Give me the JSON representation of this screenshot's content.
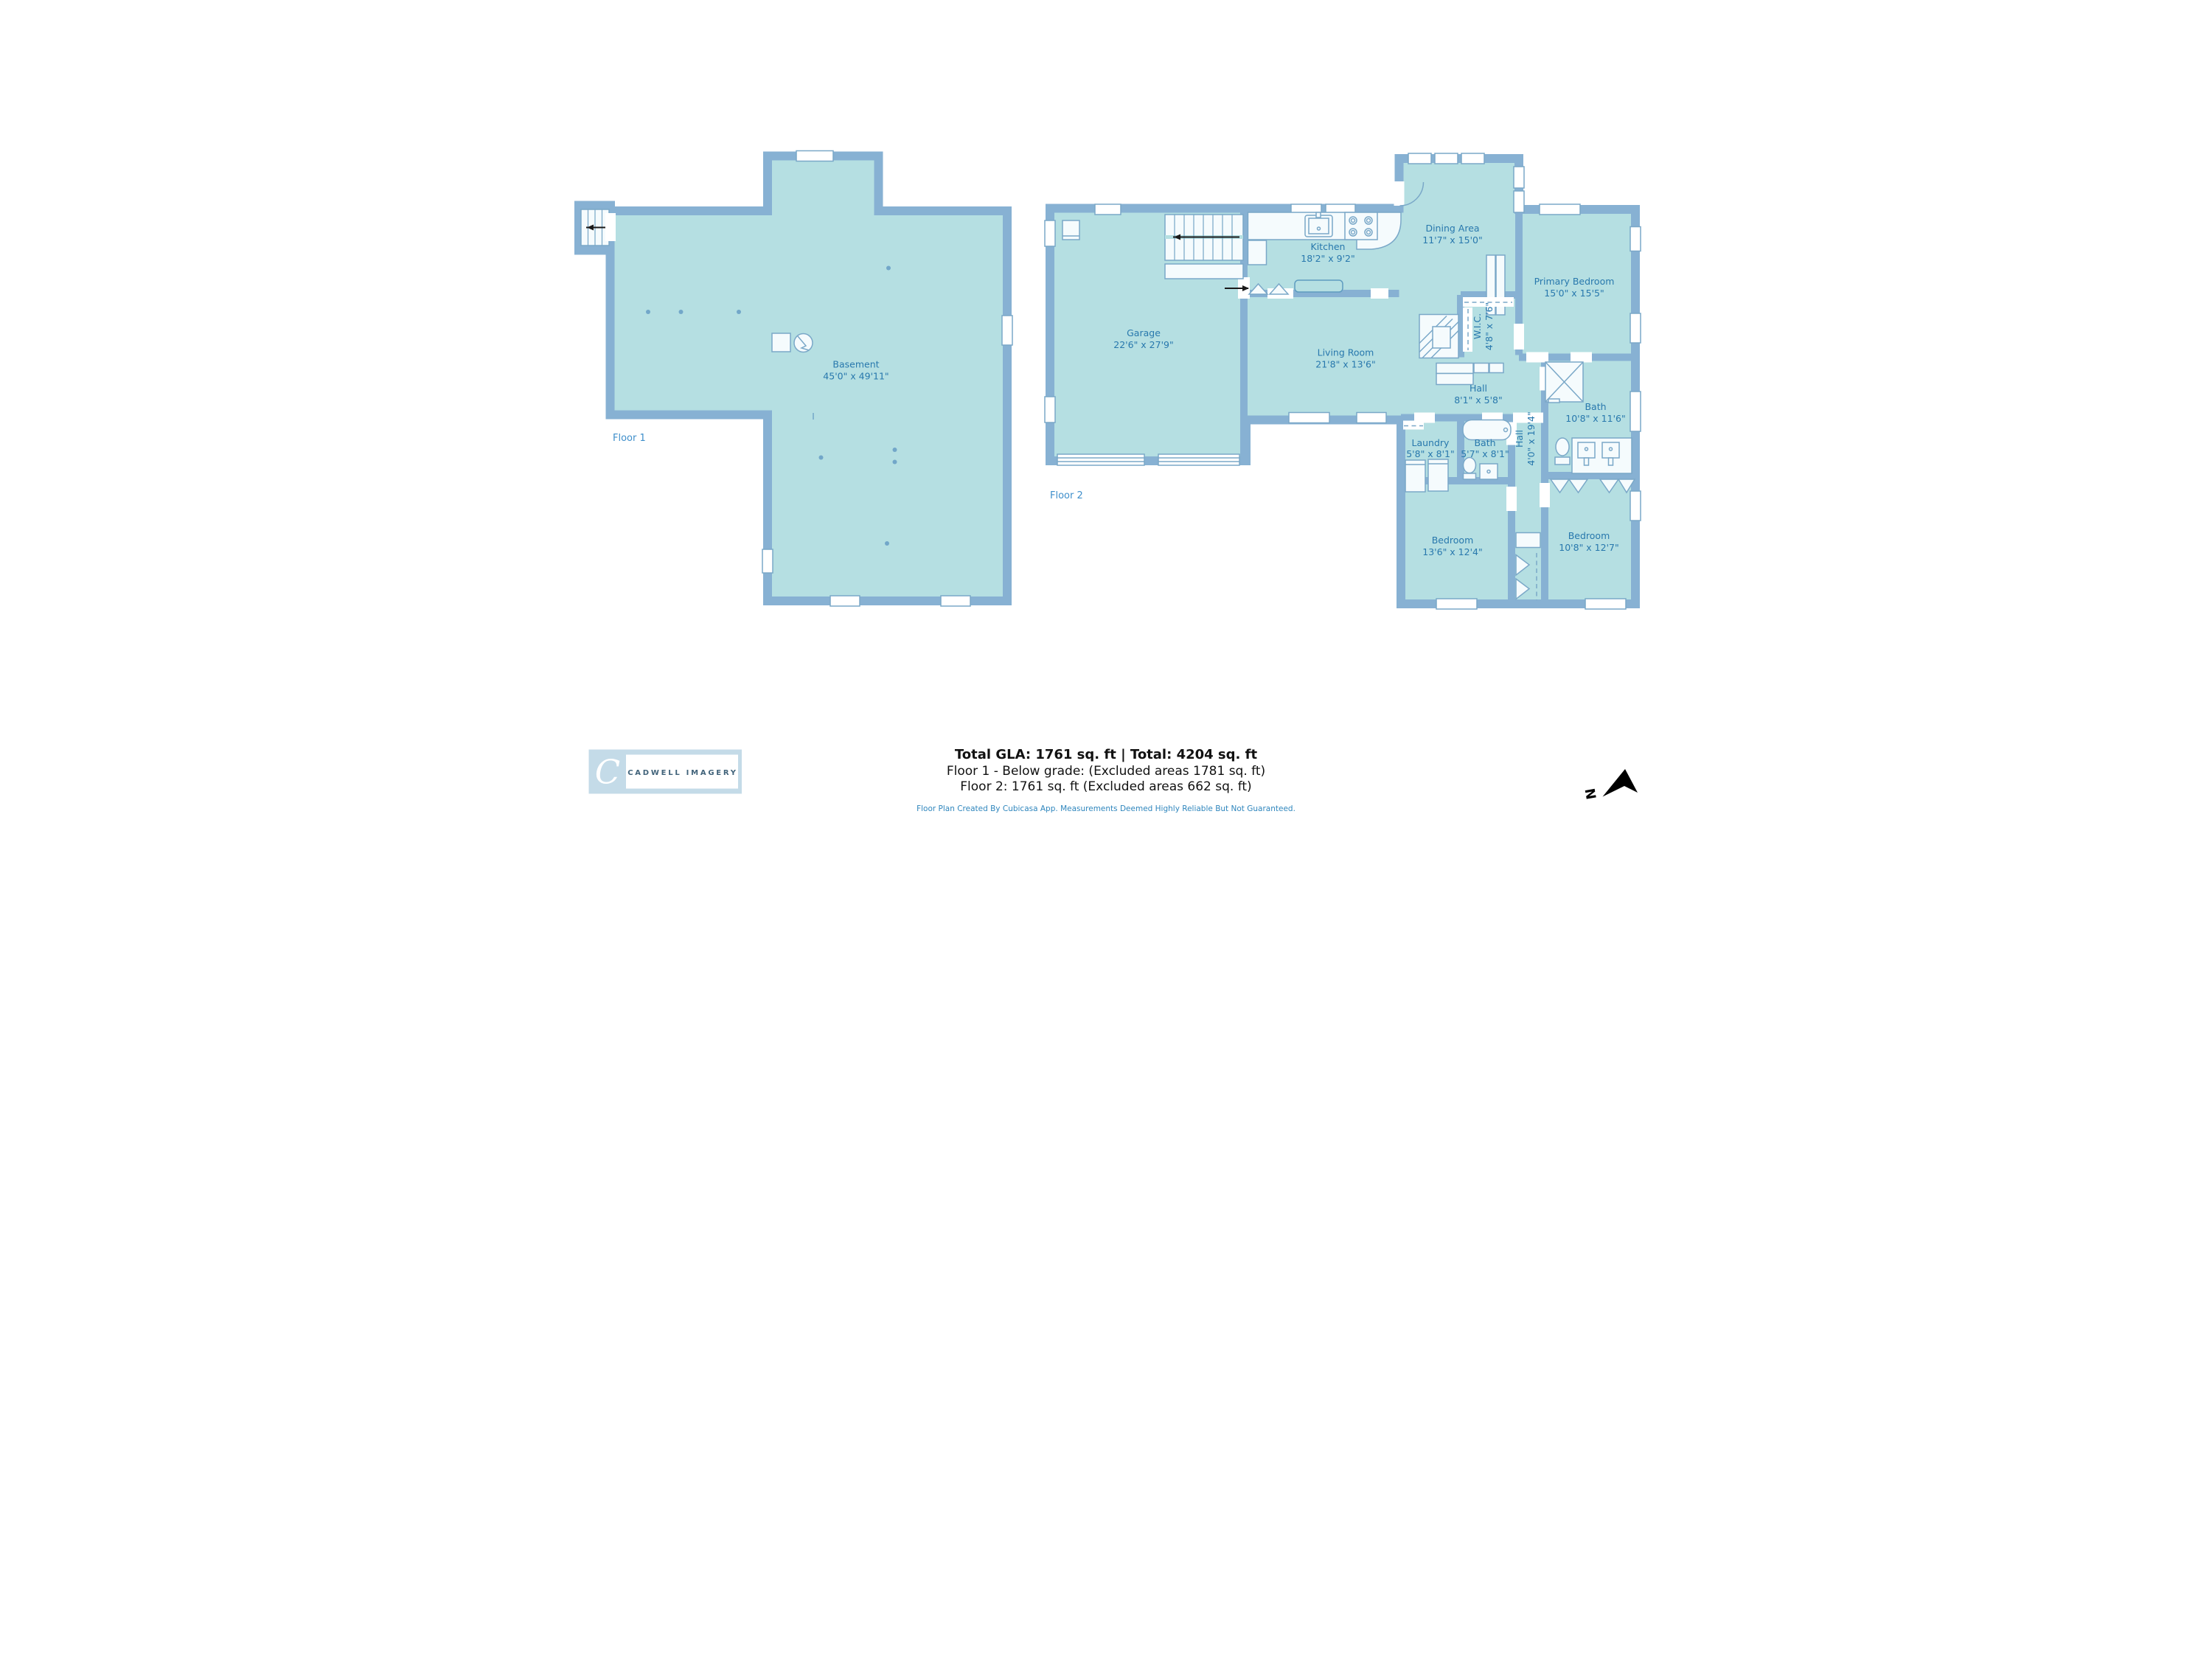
{
  "colors": {
    "floor_fill": "#b5dfe2",
    "wall": "#87b1d3",
    "fixture_fill": "#f5fbfd",
    "fixture_stroke": "#7aa8c8",
    "room_label": "#2878ad",
    "floor_label": "#3f8fcb",
    "title_text": "#111111",
    "disclaimer_text": "#2f86bd",
    "logo_bg": "#c4dbe8",
    "logo_text": "#41637a"
  },
  "floor1": {
    "label": "Floor 1",
    "room": {
      "name": "Basement",
      "dims": "45'0\" x 49'11\""
    }
  },
  "floor2": {
    "label": "Floor 2",
    "rooms": {
      "garage": {
        "name": "Garage",
        "dims": "22'6\" x 27'9\""
      },
      "kitchen": {
        "name": "Kitchen",
        "dims": "18'2\" x 9'2\""
      },
      "dining": {
        "name": "Dining Area",
        "dims": "11'7\" x 15'0\""
      },
      "living": {
        "name": "Living Room",
        "dims": "21'8\" x 13'6\""
      },
      "hall_upper": {
        "name": "Hall",
        "dims": "8'1\" x 5'8\""
      },
      "wic": {
        "name": "W.I.C.",
        "dims": "4'8\" x 7'6\""
      },
      "primary": {
        "name": "Primary Bedroom",
        "dims": "15'0\" x 15'5\""
      },
      "laundry": {
        "name": "Laundry",
        "dims": "5'8\" x 8'1\""
      },
      "bath_small": {
        "name": "Bath",
        "dims": "5'7\" x 8'1\""
      },
      "hall_long": {
        "name": "Hall",
        "dims": "4'0\" x 19'4\""
      },
      "bath_large": {
        "name": "Bath",
        "dims": "10'8\" x 11'6\""
      },
      "bedroom_left": {
        "name": "Bedroom",
        "dims": "13'6\" x 12'4\""
      },
      "bedroom_right": {
        "name": "Bedroom",
        "dims": "10'8\" x 12'7\""
      }
    }
  },
  "footer": {
    "total_line": "Total GLA: 1761 sq. ft | Total: 4204 sq. ft",
    "floor1_line": "Floor 1 - Below grade: (Excluded areas 1781 sq. ft)",
    "floor2_line": "Floor 2: 1761 sq. ft (Excluded areas 662 sq. ft)",
    "disclaimer": "Floor Plan Created By Cubicasa App. Measurements Deemed Highly Reliable But Not Guaranteed."
  },
  "logo": {
    "monogram": "C",
    "name": "CADWELL IMAGERY"
  },
  "compass": {
    "label": "N"
  }
}
